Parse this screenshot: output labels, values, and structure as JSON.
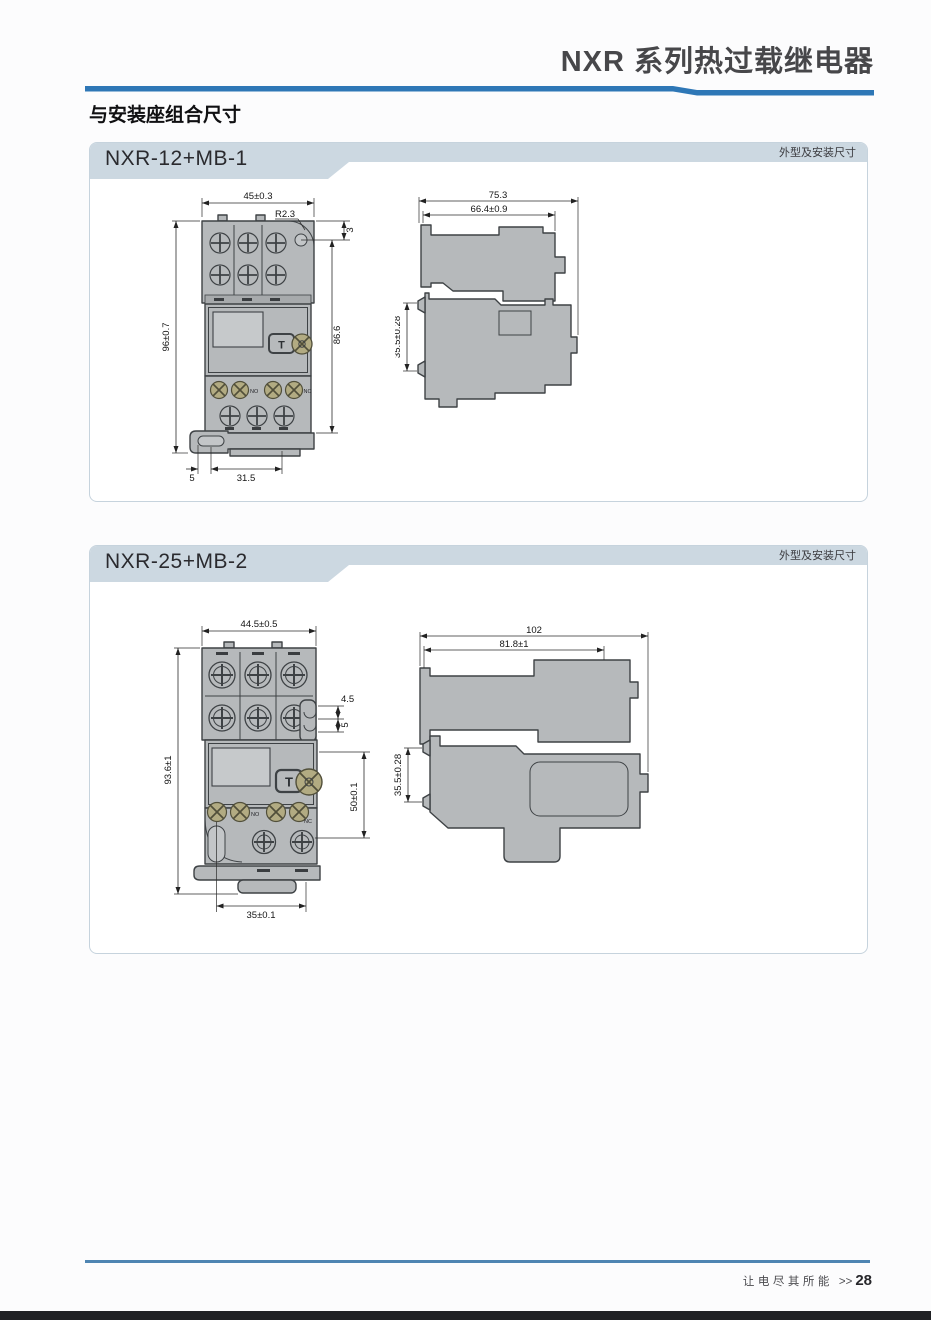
{
  "header": {
    "title": "NXR 系列热过载继电器"
  },
  "section": {
    "title": "与安装座组合尺寸"
  },
  "panel1": {
    "title": "NXR-12+MB-1",
    "corner_label": "外型及安装尺寸",
    "front": {
      "w": "45±0.3",
      "r": "R2.3",
      "o": "3",
      "h1": "96±0.7",
      "h2": "86.6",
      "b1": "5",
      "b2": "31.5",
      "t": "T",
      "no": "NO",
      "nc": "NC"
    },
    "side": {
      "d1": "75.3",
      "d2": "66.4±0.9",
      "rail": "35.5±0.28"
    }
  },
  "panel2": {
    "title": "NXR-25+MB-2",
    "corner_label": "外型及安装尺寸",
    "front": {
      "w": "44.5±0.5",
      "o1": "4.5",
      "o2": "5",
      "h1": "93.6±1",
      "h2": "50±0.1",
      "b1": "35±0.1",
      "t": "T",
      "no": "NO",
      "nc": "NC"
    },
    "side": {
      "d1": "102",
      "d2": "81.8±1",
      "rail": "35.5±0.28"
    }
  },
  "footer": {
    "tagline": "让电尽其所能",
    "arrows": ">>",
    "page": "28"
  },
  "colors": {
    "accent_blue": "#2e77b6",
    "band_blue": "#ccd8e1",
    "device_gray": "#b6b9bb"
  }
}
